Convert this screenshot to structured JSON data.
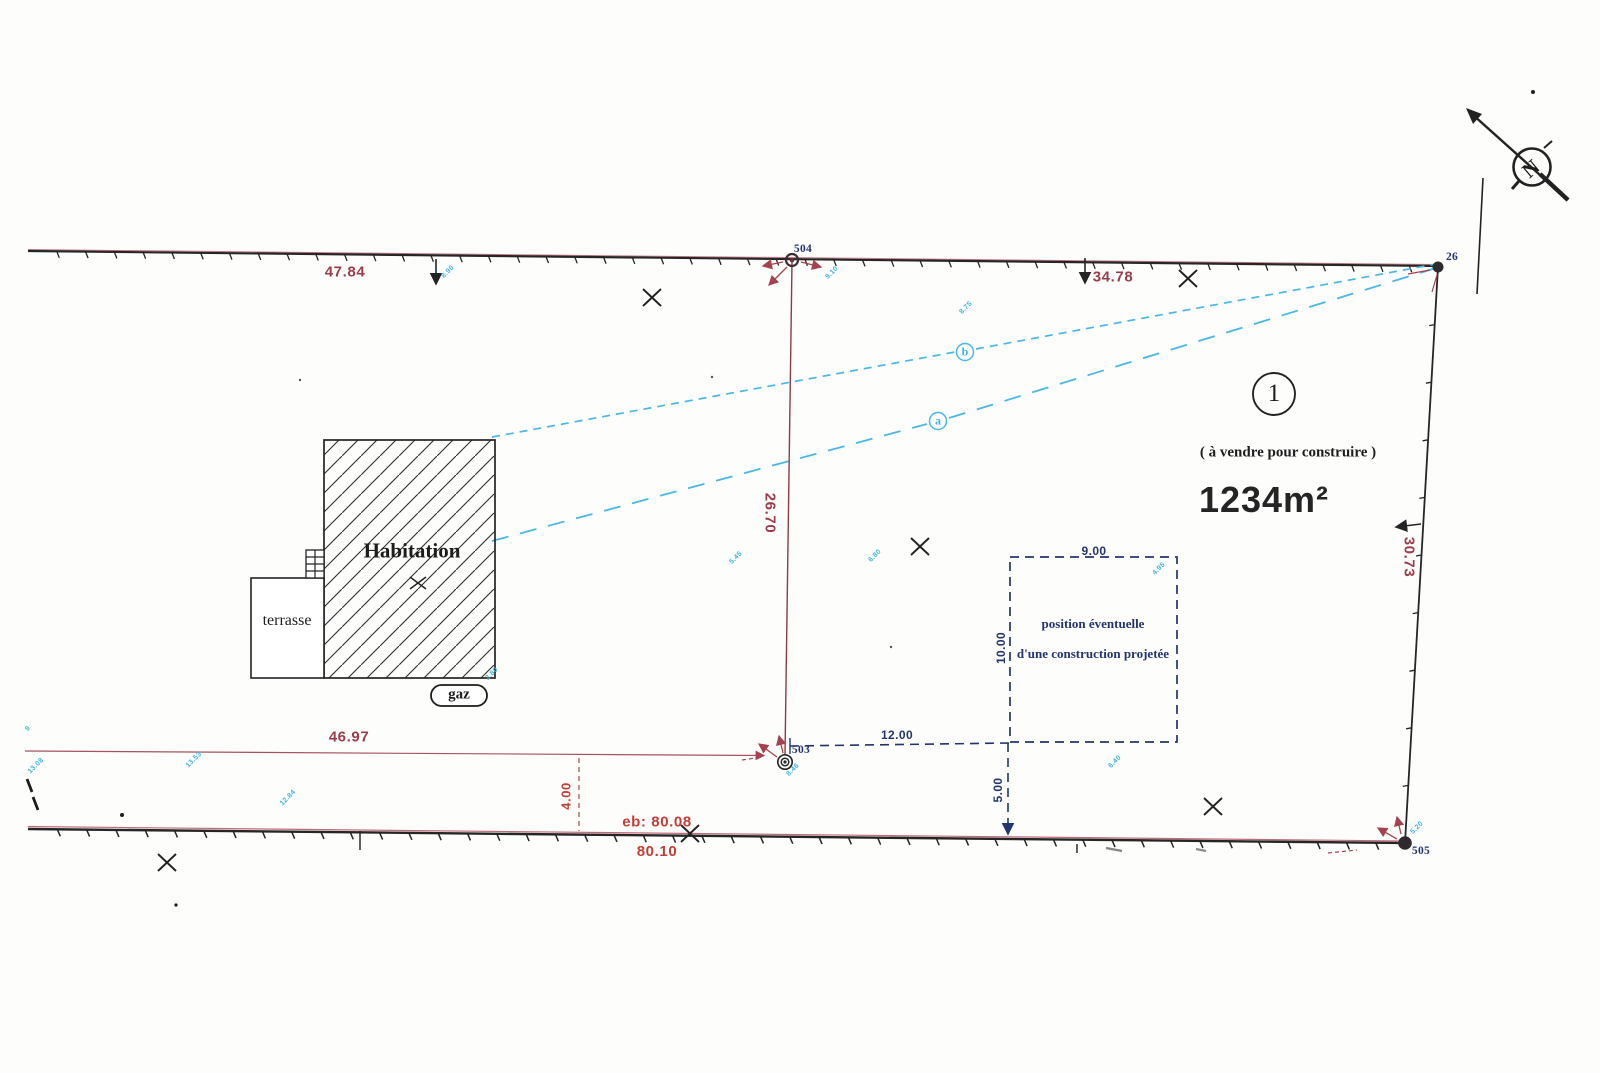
{
  "colors": {
    "dim_red": "#9c3b4b",
    "bright_red": "#c23d36",
    "navy": "#23356d",
    "cyan": "#3fb3e4",
    "line_black": "#242424"
  },
  "parcel": {
    "number": "1",
    "sale_note": "( à vendre pour construire )",
    "area": "1234m²"
  },
  "dimensions": {
    "top_left": "47.84",
    "top_right": "34.78",
    "middle_vertical": "26.70",
    "bottom_left": "46.97",
    "right_vertical": "30.73",
    "terrace_offset": "4.00",
    "eb_total": "eb: 80.08",
    "eb_below": "80.10"
  },
  "projected": {
    "line1": "position éventuelle",
    "line2": "d'une construction projetée",
    "width_label": "9.00",
    "depth_label": "10.00",
    "dist_from_503": "12.00",
    "setback_label": "5.00"
  },
  "features": {
    "house_label": "Habitation",
    "terrace_label": "terrasse",
    "gas_label": "gaz"
  },
  "points": {
    "p504": "504",
    "p503": "503",
    "p26": "26",
    "p505": "505"
  },
  "line_refs": {
    "a": "a",
    "b": "b"
  },
  "north_letter": "N",
  "tiny_annotations": [
    {
      "text": "8.90",
      "x": 448,
      "y": 272
    },
    {
      "text": "9.10",
      "x": 832,
      "y": 273
    },
    {
      "text": "8.75",
      "x": 966,
      "y": 308
    },
    {
      "text": "5.45",
      "x": 736,
      "y": 558
    },
    {
      "text": "6.80",
      "x": 875,
      "y": 556
    },
    {
      "text": "4.95",
      "x": 1159,
      "y": 569
    },
    {
      "text": "6.40",
      "x": 1115,
      "y": 762
    },
    {
      "text": "13.08",
      "x": 36,
      "y": 766
    },
    {
      "text": "13.53",
      "x": 194,
      "y": 760
    },
    {
      "text": "12.84",
      "x": 288,
      "y": 798
    },
    {
      "text": "2.80",
      "x": 492,
      "y": 674
    },
    {
      "text": "5.20",
      "x": 1417,
      "y": 828
    },
    {
      "text": "8.46",
      "x": 793,
      "y": 770
    },
    {
      "text": "9",
      "x": 28,
      "y": 729
    }
  ]
}
